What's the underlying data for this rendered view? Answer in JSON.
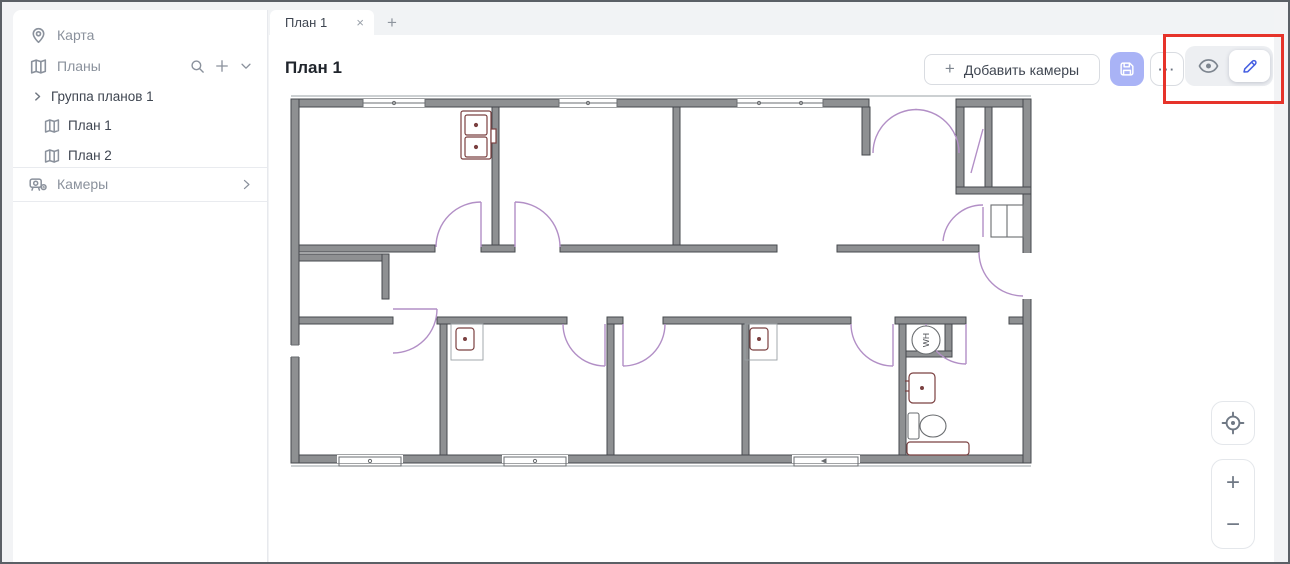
{
  "sidebar": {
    "map_label": "Карта",
    "plans_label": "Планы",
    "tree": {
      "group_label": "Группа планов 1",
      "plan1_label": "План 1",
      "plan2_label": "План 2"
    },
    "cameras_label": "Камеры"
  },
  "tabbar": {
    "active_tab_label": "План 1",
    "close_glyph": "×",
    "add_tab_glyph": "+"
  },
  "content": {
    "page_title": "План 1",
    "add_cameras_label": "Добавить камеры",
    "add_cameras_plus_glyph": "+",
    "more_glyph": "···"
  },
  "zoom_controls": {
    "zoom_in_glyph": "+",
    "zoom_out_glyph": "−"
  },
  "floorplan": {
    "water_heater_label": "WH"
  },
  "colors": {
    "accent_blue": "#455fe2",
    "save_button_bg": "#a9b3f6",
    "annotation_red": "#e6332a",
    "door_purple": "#b28fc6",
    "fixture_maroon": "#7b4040",
    "wall_gray": "#8e9092"
  }
}
